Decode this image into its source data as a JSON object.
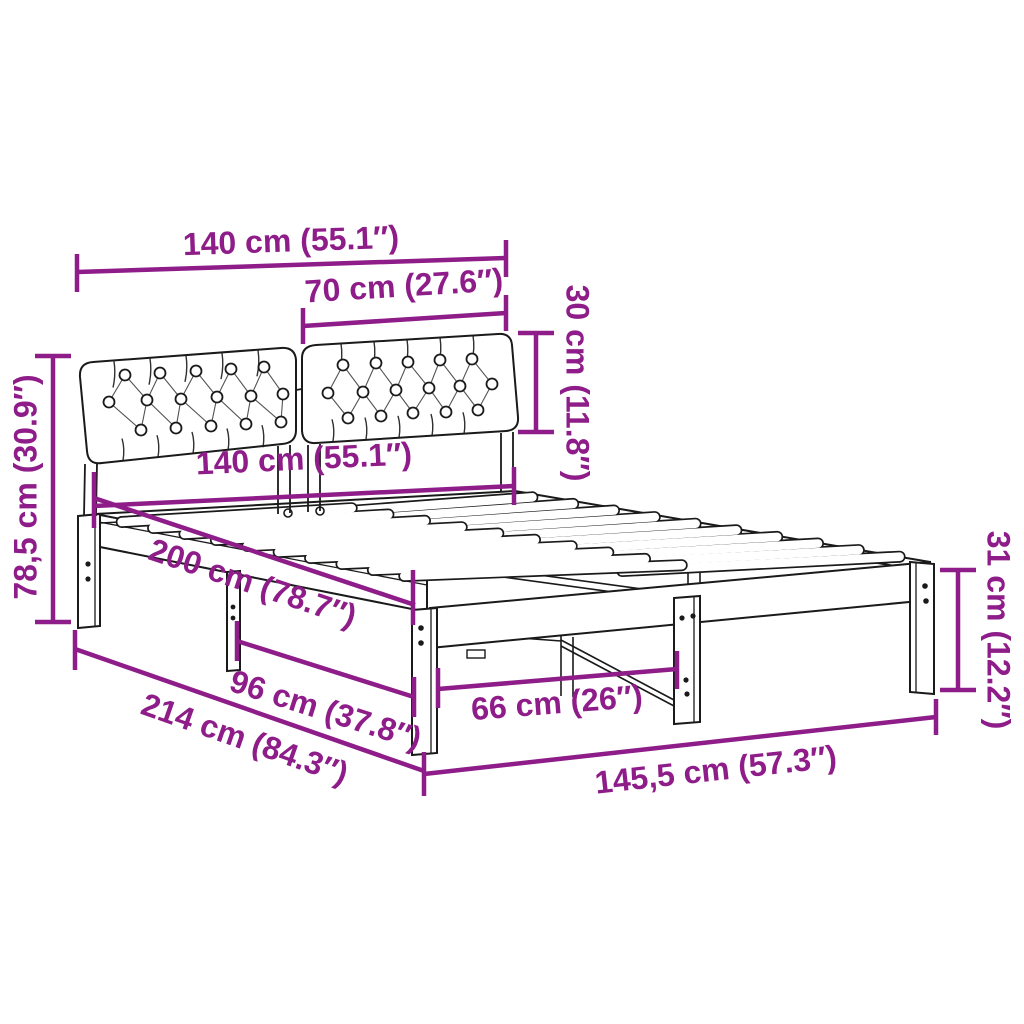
{
  "colors": {
    "dimension": "#8E1C89",
    "line": "#1a1a1a",
    "background": "#ffffff"
  },
  "product": {
    "type": "bed-frame-with-upholstered-headboard-dimension-diagram"
  },
  "dimensions": {
    "headboard_width_top": "140 cm (55.1″)",
    "cushion_width": "70 cm (27.6″)",
    "cushion_height": "30 cm (11.8″)",
    "frame_width": "140 cm (55.1″)",
    "headboard_height": "78,5 cm (30.9″)",
    "frame_length": "200 cm (78.7″)",
    "leg_spacing_side": "96 cm (37.8″)",
    "total_length": "214 cm (84.3″)",
    "leg_spacing_foot": "66 cm (26″)",
    "leg_height": "31 cm (12.2″)",
    "total_width": "145,5 cm (57.3″)"
  }
}
